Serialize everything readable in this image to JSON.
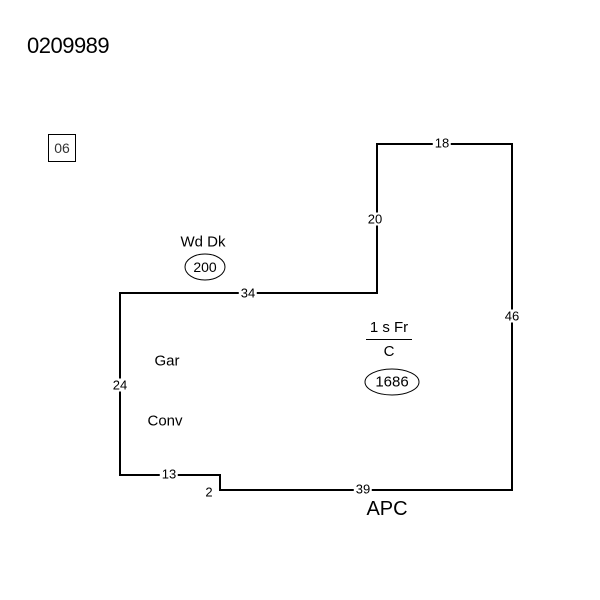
{
  "sketch": {
    "file_number": "0209989",
    "neighborhood_code": "06",
    "colors": {
      "background": "#ffffff",
      "line": "#000000",
      "text": "#000000"
    },
    "dimensions": {
      "top": "18",
      "upper_vertical": "20",
      "right": "46",
      "middle_horizontal": "34",
      "left": "24",
      "bottom_left": "13",
      "step": "2",
      "bottom": "39"
    },
    "areas": {
      "deck_label": "Wd Dk",
      "deck_area": "200",
      "garage_label": "Gar",
      "conversion_label": "Conv",
      "main_story_label": "1 s Fr",
      "main_foundation_label": "C",
      "main_area": "1686",
      "porch_label": "APC"
    }
  }
}
